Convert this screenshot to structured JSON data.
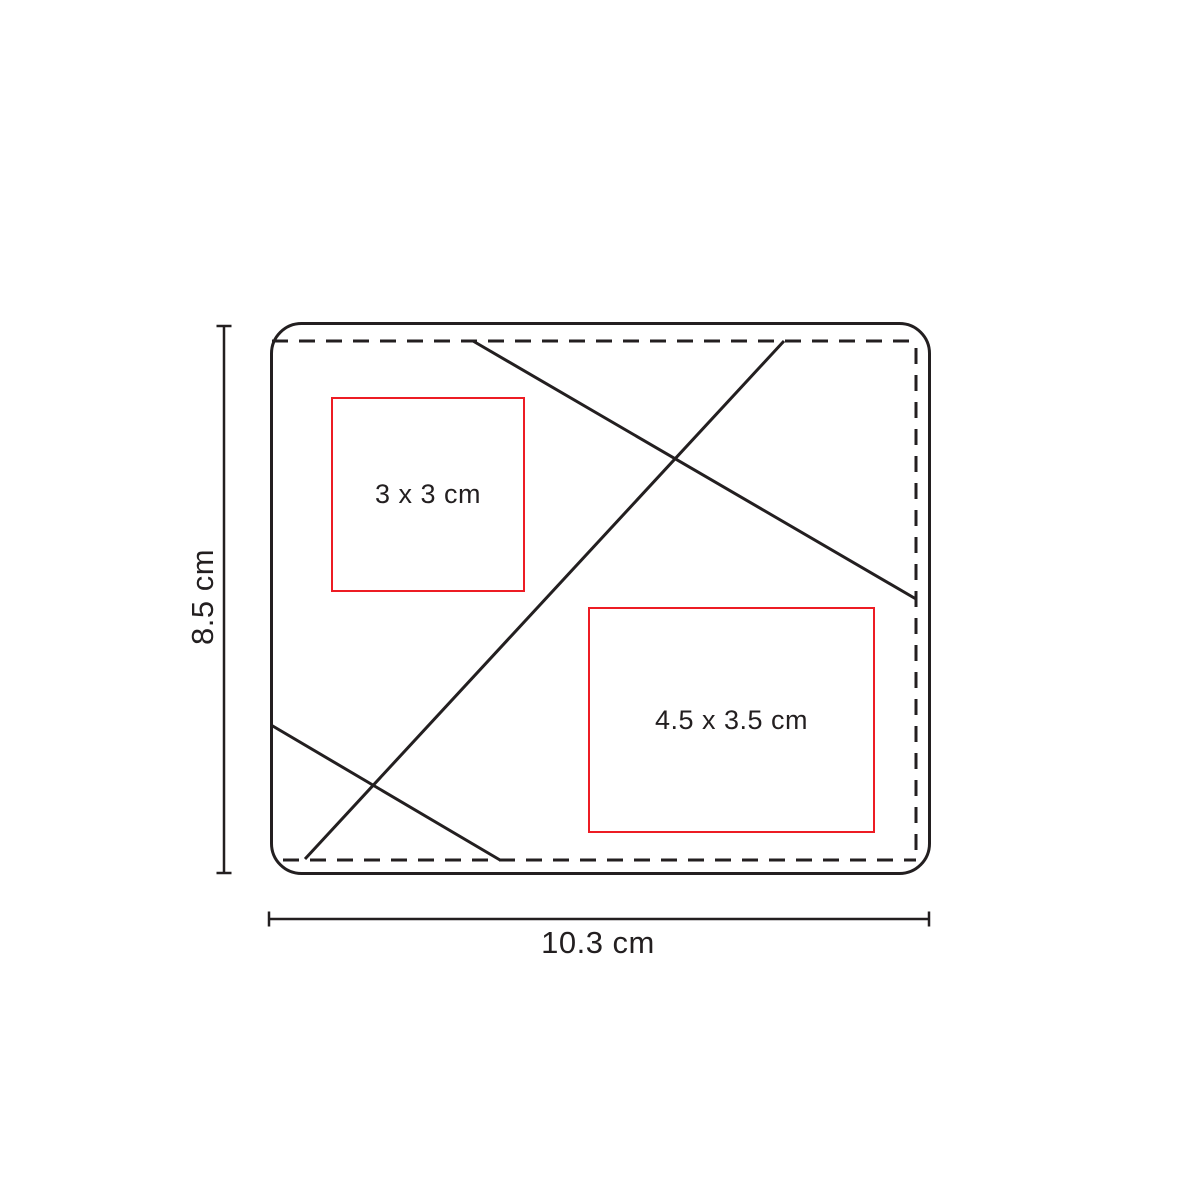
{
  "diagram": {
    "print_areas": [
      {
        "label": "3 x 3 cm"
      },
      {
        "label": "4.5 x 3.5 cm"
      }
    ],
    "dimensions": {
      "height_label": "8.5 cm",
      "width_label": "10.3 cm"
    },
    "colors": {
      "line": "#231f20",
      "print_area_border": "#ed1c24",
      "background": "#ffffff"
    }
  }
}
